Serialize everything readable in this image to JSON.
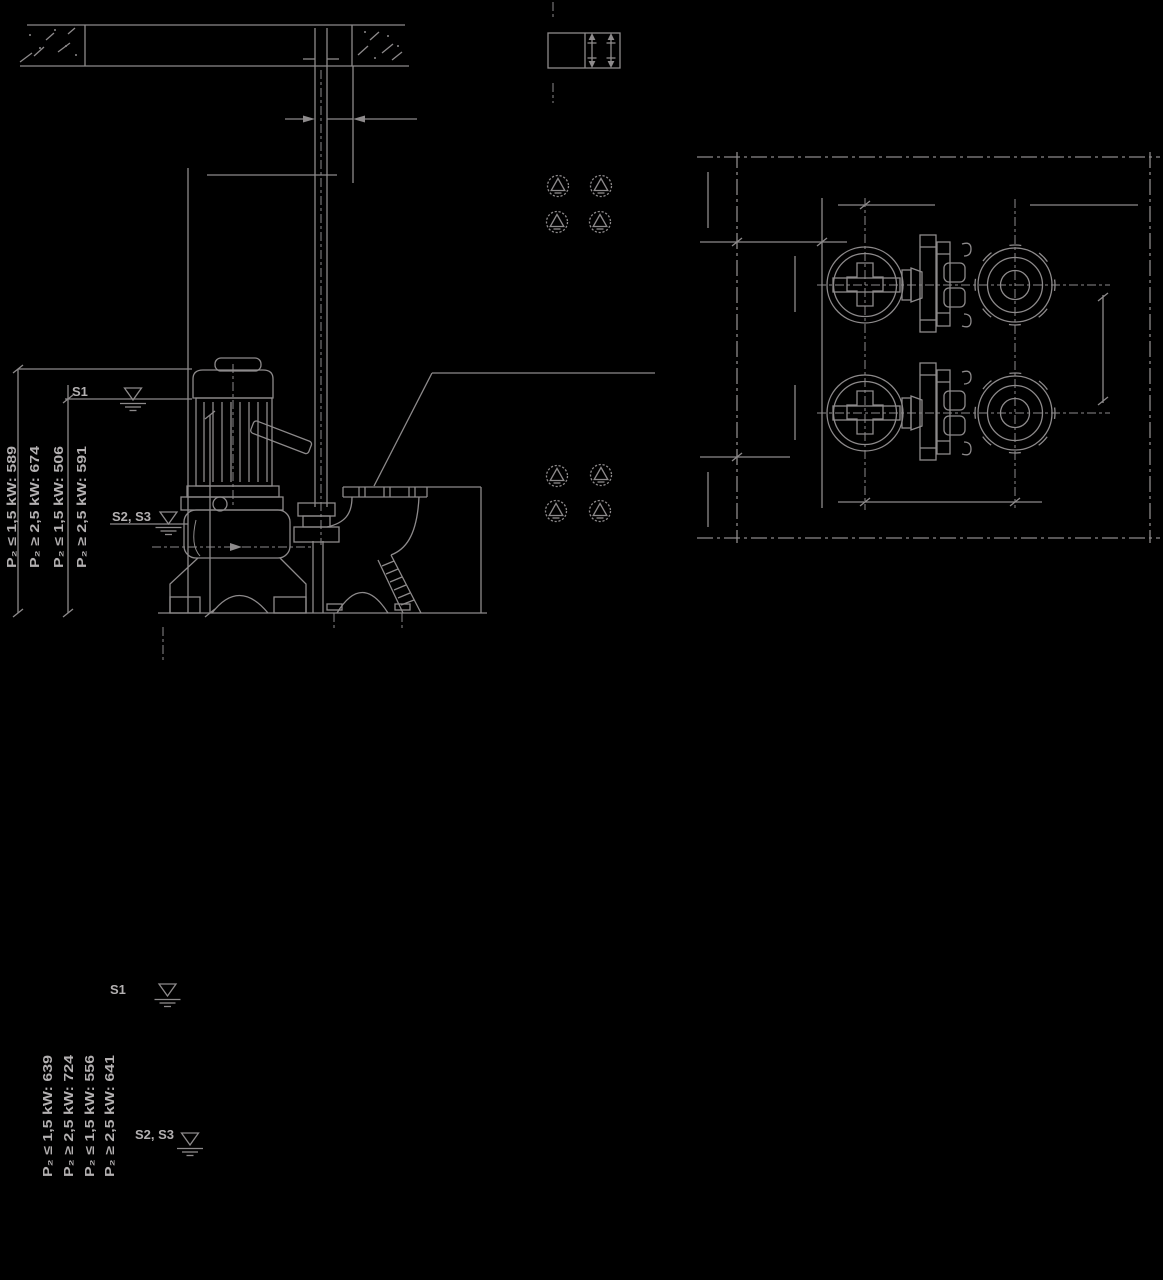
{
  "drawing": {
    "section_view": {
      "s1_label": "S1",
      "s2_s3_label": "S2, S3",
      "dim_labels": [
        "P₂ ≤ 1,5 kW: 589",
        "P₂ ≥ 2,5 kW: 674",
        "P₂ ≤ 1,5 kW: 506",
        "P₂ ≥ 2,5 kW: 591"
      ]
    },
    "floor_view": {
      "s1_label": "S1",
      "s2_s3_label": "S2, S3",
      "dim_labels": [
        "P₂ ≤ 1,5 kW: 639",
        "P₂ ≥ 2,5 kW: 724",
        "P₂ ≤ 1,5 kW: 556",
        "P₂ ≥ 2,5 kW: 641"
      ]
    },
    "colors": {
      "background": "#000000",
      "ink": "#8d8a8b",
      "text": "#b3b0b1"
    }
  }
}
